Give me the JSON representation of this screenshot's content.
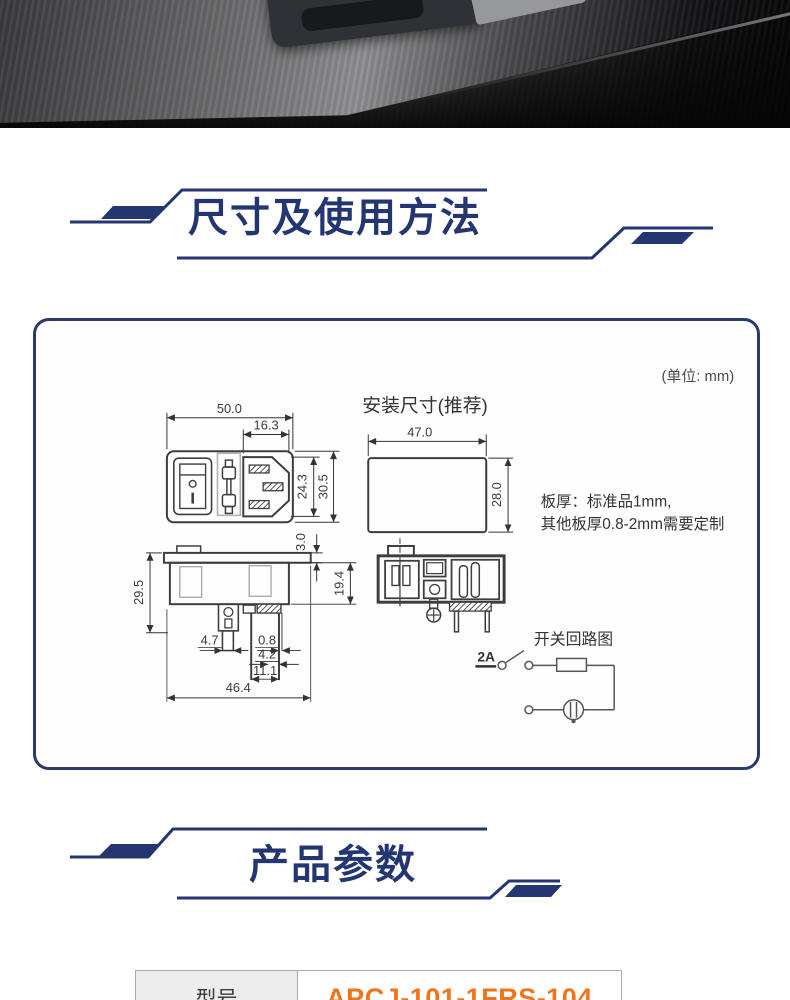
{
  "photo": {
    "description": "brushed metal panel with mounted power socket module"
  },
  "sections": {
    "dimensions": {
      "title": "尺寸及使用方法"
    },
    "params": {
      "title": "产品参数"
    }
  },
  "diagram": {
    "unit_note": "(单位: mm)",
    "install_label": "安装尺寸(推荐)",
    "plate_note_line1": "板厚：标准品1mm,",
    "plate_note_line2": "其他板厚0.8-2mm需要定制",
    "front_view": {
      "total_width": "50.0",
      "inlet_width": "16.3",
      "inlet_height": "24.3",
      "total_height": "30.5"
    },
    "cutout": {
      "width": "47.0",
      "height": "28.0"
    },
    "side_view": {
      "total_depth": "29.5",
      "flange_thickness": "3.0",
      "body_depth": "19.4",
      "terminal_width": "4.7",
      "wall_thickness": "0.8",
      "terminal_pitch": "4.2",
      "terminal_span": "11.1",
      "bottom_width": "46.4"
    },
    "circuit": {
      "label": "开关回路图",
      "current": "2A"
    }
  },
  "params_table": {
    "rows": [
      {
        "label": "型号",
        "value": "APCJ-101-1FRS-104"
      }
    ]
  },
  "colors": {
    "navy": "#243672",
    "orange": "#f0741c",
    "drawing_line": "#3d3d3d",
    "table_header_bg": "#ededed"
  }
}
